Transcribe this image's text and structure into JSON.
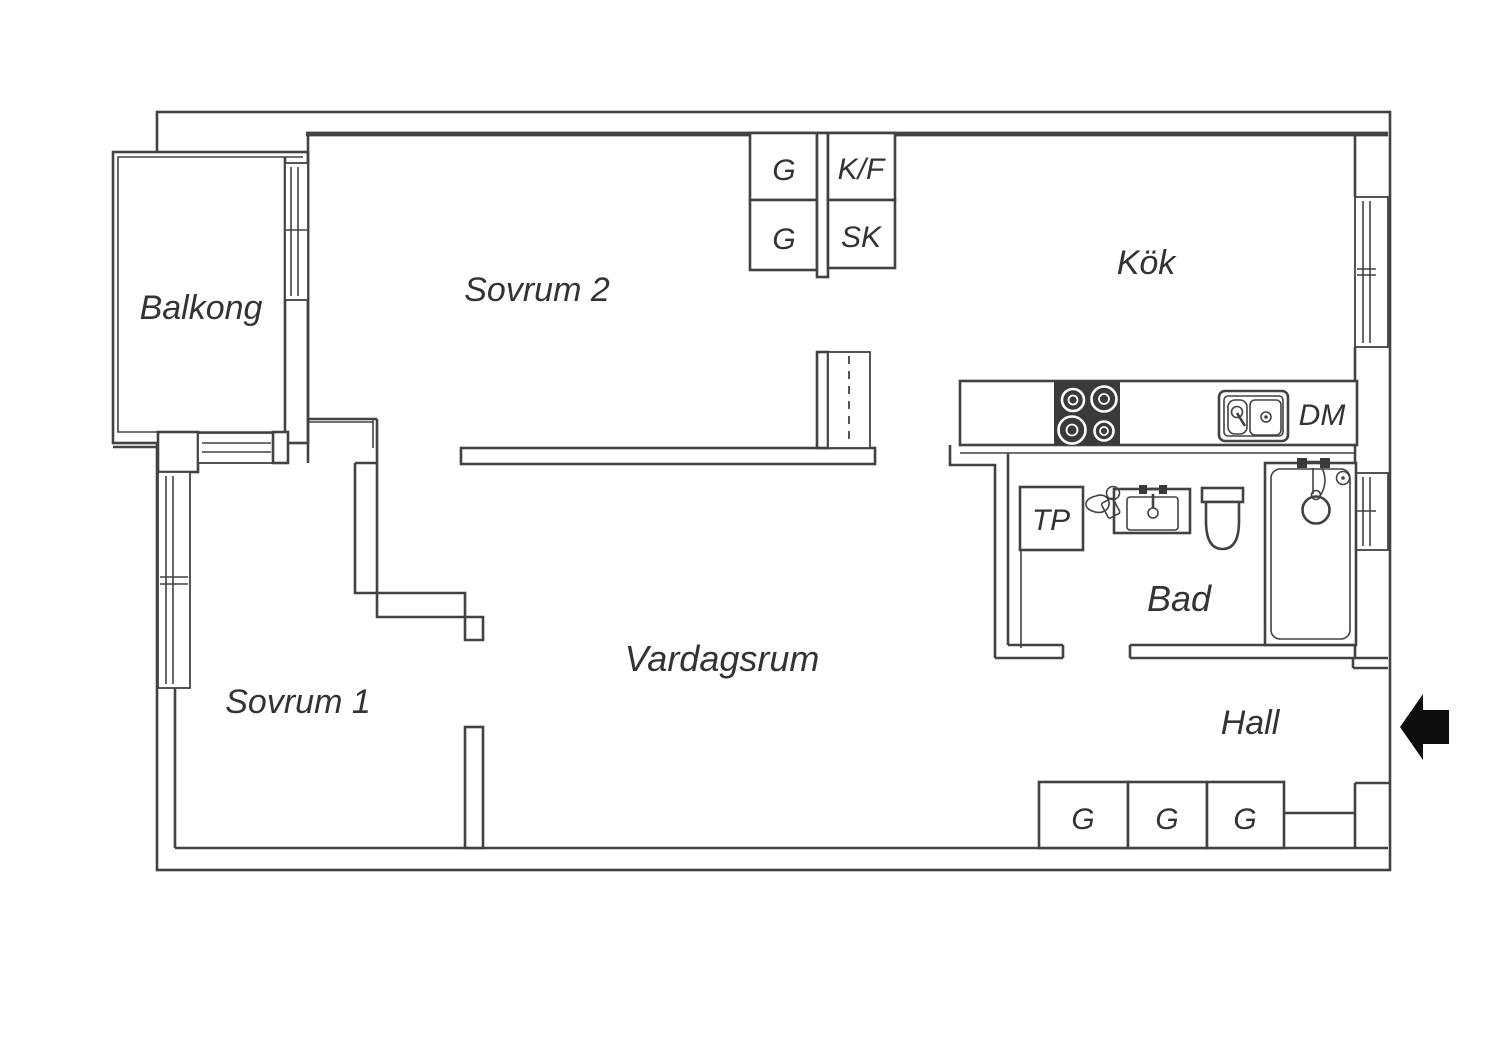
{
  "plan": {
    "type": "apartment-floor-plan",
    "rooms": {
      "balkong": {
        "label": "Balkong"
      },
      "sovrum2": {
        "label": "Sovrum 2"
      },
      "kok": {
        "label": "Kök"
      },
      "sovrum1": {
        "label": "Sovrum 1"
      },
      "vardagsrum": {
        "label": "Vardagsrum"
      },
      "bad": {
        "label": "Bad"
      },
      "hall": {
        "label": "Hall"
      }
    },
    "fixtures": {
      "closet_g1": {
        "label": "G"
      },
      "closet_g2": {
        "label": "G"
      },
      "fridge_freezer": {
        "label": "K/F"
      },
      "cabinet_sk": {
        "label": "SK"
      },
      "dishwasher": {
        "label": "DM"
      },
      "dryer_tp": {
        "label": "TP"
      },
      "hall_g1": {
        "label": "G"
      },
      "hall_g2": {
        "label": "G"
      },
      "hall_g3": {
        "label": "G"
      }
    },
    "colors": {
      "background": "#ffffff",
      "line": "#424242",
      "text": "#333333",
      "stove": "#3a3a3a",
      "arrow": "#0d0d0d"
    }
  }
}
